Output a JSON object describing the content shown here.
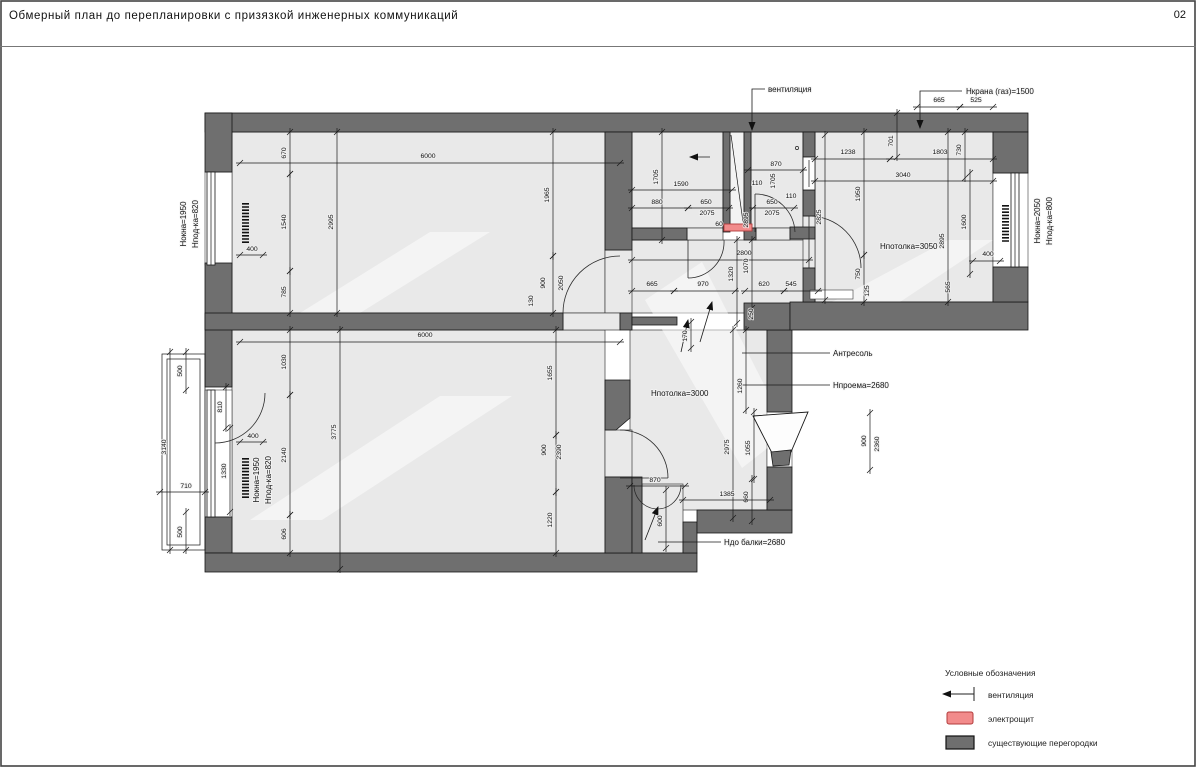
{
  "header": {
    "title": "Обмерный план до перепланировки с призязкой инженерных коммуникаций",
    "page": "02"
  },
  "legend": {
    "title": "Условные обозначения",
    "items": [
      {
        "label": "вентиляция",
        "symbol": "vent-arrow"
      },
      {
        "label": "электрощит",
        "symbol": "electro-panel"
      },
      {
        "label": "существующие перегородки",
        "symbol": "existing-partition"
      }
    ]
  },
  "colors": {
    "wall": "#6f6f6f",
    "floor": "#e9e9e9",
    "electro_panel": "#f28b8b",
    "line": "#1a1a1a"
  },
  "plan": {
    "labels": [
      {
        "t": "вентиляция",
        "x": 768,
        "y": 92,
        "a": "start"
      },
      {
        "t": "Нкрана (газ)=1500",
        "x": 966,
        "y": 94,
        "a": "start"
      },
      {
        "t": "Нпотолка=3050",
        "x": 880,
        "y": 249,
        "a": "start"
      },
      {
        "t": "Антресоль",
        "x": 833,
        "y": 356,
        "a": "start"
      },
      {
        "t": "Нпроема=2680",
        "x": 833,
        "y": 388,
        "a": "start"
      },
      {
        "t": "Нпотолка=3000",
        "x": 651,
        "y": 396,
        "a": "start"
      },
      {
        "t": "Ндо балки=2680",
        "x": 724,
        "y": 545,
        "a": "start"
      },
      {
        "t": "Нокна=1950",
        "x": 186,
        "y": 224,
        "r": -90
      },
      {
        "t": "Нпод-ка=820",
        "x": 198,
        "y": 224,
        "r": -90
      },
      {
        "t": "Нокна=1950",
        "x": 259,
        "y": 480,
        "r": -90
      },
      {
        "t": "Нпод-ка=820",
        "x": 271,
        "y": 480,
        "r": -90
      },
      {
        "t": "Нокна=2050",
        "x": 1040,
        "y": 221,
        "r": -90
      },
      {
        "t": "Нпод-ка=800",
        "x": 1052,
        "y": 221,
        "r": -90
      }
    ],
    "dims": [
      {
        "t": "670",
        "x": 286,
        "y": 153,
        "r": -90,
        "l": [
          290,
          132,
          290,
          174
        ]
      },
      {
        "t": "1540",
        "x": 286,
        "y": 222,
        "r": -90,
        "l": [
          290,
          174,
          290,
          271
        ]
      },
      {
        "t": "785",
        "x": 286,
        "y": 292,
        "r": -90,
        "l": [
          290,
          271,
          290,
          313
        ]
      },
      {
        "t": "6000",
        "x": 428,
        "y": 158,
        "l": [
          240,
          163,
          620,
          163
        ]
      },
      {
        "t": "2995",
        "x": 333,
        "y": 222,
        "r": -90,
        "l": [
          337,
          132,
          337,
          313
        ]
      },
      {
        "t": "1965",
        "x": 549,
        "y": 195,
        "r": -90,
        "l": [
          553,
          132,
          553,
          256
        ]
      },
      {
        "t": "900",
        "x": 545,
        "y": 283,
        "r": -90,
        "l": [
          553,
          256,
          553,
          313
        ]
      },
      {
        "t": "2050",
        "x": 563,
        "y": 283,
        "r": -90
      },
      {
        "t": "130",
        "x": 533,
        "y": 301,
        "r": -90
      },
      {
        "t": "400",
        "x": 252,
        "y": 251,
        "l": [
          240,
          255,
          263,
          255
        ]
      },
      {
        "t": "6000",
        "x": 425,
        "y": 337,
        "l": [
          240,
          342,
          620,
          342
        ]
      },
      {
        "t": "1030",
        "x": 286,
        "y": 362,
        "r": -90,
        "l": [
          290,
          330,
          290,
          395
        ]
      },
      {
        "t": "2140",
        "x": 286,
        "y": 455,
        "r": -90,
        "l": [
          290,
          395,
          290,
          515
        ]
      },
      {
        "t": "606",
        "x": 286,
        "y": 534,
        "r": -90,
        "l": [
          290,
          515,
          290,
          553
        ]
      },
      {
        "t": "3775",
        "x": 336,
        "y": 432,
        "r": -90,
        "l": [
          340,
          330,
          340,
          569
        ]
      },
      {
        "t": "1655",
        "x": 552,
        "y": 373,
        "r": -90,
        "l": [
          556,
          330,
          556,
          435
        ]
      },
      {
        "t": "900",
        "x": 546,
        "y": 450,
        "r": -90,
        "l": [
          556,
          435,
          556,
          492
        ]
      },
      {
        "t": "2390",
        "x": 561,
        "y": 452,
        "r": -90
      },
      {
        "t": "1220",
        "x": 552,
        "y": 520,
        "r": -90,
        "l": [
          556,
          492,
          556,
          553
        ]
      },
      {
        "t": "400",
        "x": 253,
        "y": 438,
        "l": [
          240,
          442,
          263,
          442
        ]
      },
      {
        "t": "500",
        "x": 182,
        "y": 371,
        "r": -90,
        "l": [
          186,
          352,
          186,
          390
        ]
      },
      {
        "t": "3140",
        "x": 166,
        "y": 447,
        "r": -90,
        "l": [
          170,
          352,
          170,
          550
        ]
      },
      {
        "t": "710",
        "x": 186,
        "y": 488,
        "l": [
          160,
          492,
          205,
          492
        ]
      },
      {
        "t": "500",
        "x": 182,
        "y": 532,
        "r": -90,
        "l": [
          186,
          512,
          186,
          550
        ]
      },
      {
        "t": "810",
        "x": 222,
        "y": 407,
        "r": -90,
        "l": [
          226,
          387,
          226,
          428
        ]
      },
      {
        "t": "1330",
        "x": 226,
        "y": 471,
        "r": -90,
        "l": [
          230,
          428,
          230,
          512
        ]
      },
      {
        "t": "665",
        "x": 939,
        "y": 102,
        "l": [
          917,
          107,
          960,
          107
        ]
      },
      {
        "t": "525",
        "x": 976,
        "y": 102,
        "l": [
          960,
          107,
          993,
          107
        ]
      },
      {
        "t": "1705",
        "x": 658,
        "y": 177,
        "r": -90,
        "l": [
          662,
          132,
          662,
          240
        ]
      },
      {
        "t": "1590",
        "x": 681,
        "y": 186,
        "l": [
          632,
          190,
          732,
          190
        ]
      },
      {
        "t": "880",
        "x": 657,
        "y": 204,
        "l": [
          632,
          208,
          688,
          208
        ]
      },
      {
        "t": "650",
        "x": 706,
        "y": 204,
        "l": [
          688,
          208,
          729,
          208
        ]
      },
      {
        "t": "2075",
        "x": 707,
        "y": 215
      },
      {
        "t": "60",
        "x": 719,
        "y": 226
      },
      {
        "t": "870",
        "x": 776,
        "y": 166,
        "l": [
          748,
          170,
          803,
          170
        ]
      },
      {
        "t": "110",
        "x": 757,
        "y": 185
      },
      {
        "t": "1705",
        "x": 775,
        "y": 181,
        "r": -90
      },
      {
        "t": "650",
        "x": 772,
        "y": 204,
        "l": [
          753,
          208,
          794,
          208
        ]
      },
      {
        "t": "2075",
        "x": 772,
        "y": 215
      },
      {
        "t": "110",
        "x": 791,
        "y": 198
      },
      {
        "t": "2895",
        "x": 748,
        "y": 220,
        "r": -90
      },
      {
        "t": "2825",
        "x": 821,
        "y": 217,
        "r": -90,
        "l": [
          825,
          135,
          825,
          300
        ]
      },
      {
        "t": "1238",
        "x": 848,
        "y": 154,
        "l": [
          815,
          159,
          890,
          159
        ]
      },
      {
        "t": "1803",
        "x": 940,
        "y": 154,
        "l": [
          890,
          159,
          993,
          159
        ]
      },
      {
        "t": "730",
        "x": 961,
        "y": 150,
        "r": -90,
        "l": [
          965,
          132,
          965,
          178
        ]
      },
      {
        "t": "701",
        "x": 893,
        "y": 141,
        "r": -90,
        "l": [
          897,
          113,
          897,
          157
        ]
      },
      {
        "t": "3040",
        "x": 903,
        "y": 177,
        "l": [
          815,
          181,
          993,
          181
        ]
      },
      {
        "t": "1950",
        "x": 860,
        "y": 194,
        "r": -90,
        "l": [
          864,
          132,
          864,
          255
        ]
      },
      {
        "t": "2895",
        "x": 944,
        "y": 241,
        "r": -90,
        "l": [
          948,
          132,
          948,
          302
        ]
      },
      {
        "t": "1600",
        "x": 966,
        "y": 222,
        "r": -90,
        "l": [
          970,
          173,
          970,
          274
        ]
      },
      {
        "t": "400",
        "x": 988,
        "y": 256,
        "l": [
          973,
          261,
          1000,
          261
        ]
      },
      {
        "t": "565",
        "x": 950,
        "y": 287,
        "r": -90
      },
      {
        "t": "750",
        "x": 860,
        "y": 274,
        "r": -90,
        "l": [
          864,
          255,
          864,
          302
        ]
      },
      {
        "t": "125",
        "x": 869,
        "y": 291,
        "r": -90
      },
      {
        "t": "2800",
        "x": 744,
        "y": 255,
        "l": [
          632,
          260,
          809,
          260
        ]
      },
      {
        "t": "1320",
        "x": 733,
        "y": 274,
        "r": -90,
        "l": [
          737,
          240,
          737,
          323
        ]
      },
      {
        "t": "1070",
        "x": 748,
        "y": 266,
        "r": -90,
        "l": [
          752,
          240,
          752,
          308
        ]
      },
      {
        "t": "665",
        "x": 652,
        "y": 286,
        "l": [
          632,
          291,
          674,
          291
        ]
      },
      {
        "t": "970",
        "x": 703,
        "y": 286,
        "l": [
          674,
          291,
          735,
          291
        ]
      },
      {
        "t": "620",
        "x": 764,
        "y": 286,
        "l": [
          745,
          291,
          784,
          291
        ]
      },
      {
        "t": "545",
        "x": 791,
        "y": 286,
        "l": [
          784,
          291,
          818,
          291
        ]
      },
      {
        "t": "250",
        "x": 753,
        "y": 314,
        "r": -90
      },
      {
        "t": "170",
        "x": 687,
        "y": 336,
        "r": -90,
        "l": [
          691,
          322,
          691,
          348
        ]
      },
      {
        "t": "1260",
        "x": 742,
        "y": 386,
        "r": -90,
        "l": [
          746,
          330,
          746,
          410
        ]
      },
      {
        "t": "2975",
        "x": 729,
        "y": 447,
        "r": -90,
        "l": [
          733,
          330,
          733,
          518
        ]
      },
      {
        "t": "1055",
        "x": 750,
        "y": 448,
        "r": -90,
        "l": [
          754,
          412,
          754,
          479
        ]
      },
      {
        "t": "660",
        "x": 748,
        "y": 497,
        "r": -90,
        "l": [
          752,
          479,
          752,
          521
        ]
      },
      {
        "t": "1385",
        "x": 727,
        "y": 496,
        "l": [
          683,
          500,
          770,
          500
        ]
      },
      {
        "t": "900",
        "x": 866,
        "y": 441,
        "r": -90,
        "l": [
          870,
          413,
          870,
          470
        ]
      },
      {
        "t": "2360",
        "x": 879,
        "y": 444,
        "r": -90
      },
      {
        "t": "870",
        "x": 655,
        "y": 482,
        "l": [
          630,
          486,
          685,
          486
        ]
      },
      {
        "t": "600",
        "x": 662,
        "y": 521,
        "r": -90,
        "l": [
          666,
          490,
          666,
          548
        ]
      }
    ],
    "leaders": [
      {
        "pts": "765,89 752,89 752,130",
        "arrow": true
      },
      {
        "pts": "962,91 920,91 920,128",
        "arrow": true
      },
      {
        "pts": "830,353 742,353"
      },
      {
        "pts": "830,385 742,385"
      },
      {
        "pts": "721,542 658,542"
      },
      {
        "pts": "710,157 690,157",
        "arrow": true
      },
      {
        "pts": "700,342 712,302",
        "arrow": true
      },
      {
        "pts": "681,352 688,320",
        "arrow": true
      },
      {
        "pts": "645,540 658,507",
        "arrow": true
      }
    ]
  }
}
